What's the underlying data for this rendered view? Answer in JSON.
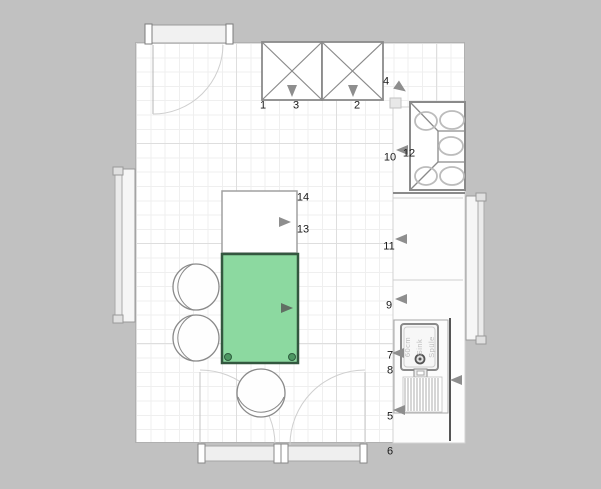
{
  "plan": {
    "colors": {
      "background": "#c1c1c1",
      "floor": "#ffffff",
      "grid_minor": "#efefef",
      "grid_major": "#dedede",
      "outline_gray": "#8a8a8a",
      "selection_fill": "#8cd9a0",
      "selection_border": "#33573f",
      "selection_handle": "#4d9762",
      "marker_gray": "#8e8e8e",
      "marker_dark": "#616f63"
    },
    "item_labels": [
      {
        "text": "1",
        "x": 263,
        "y": 106
      },
      {
        "text": "2",
        "x": 357,
        "y": 106
      },
      {
        "text": "3",
        "x": 296,
        "y": 106
      },
      {
        "text": "4",
        "x": 386,
        "y": 82
      },
      {
        "text": "5",
        "x": 390,
        "y": 417
      },
      {
        "text": "6",
        "x": 390,
        "y": 452
      },
      {
        "text": "7",
        "x": 390,
        "y": 356
      },
      {
        "text": "8",
        "x": 390,
        "y": 371
      },
      {
        "text": "9",
        "x": 389,
        "y": 306
      },
      {
        "text": "10",
        "x": 390,
        "y": 158
      },
      {
        "text": "11",
        "x": 389,
        "y": 247
      },
      {
        "text": "12",
        "x": 409,
        "y": 154
      },
      {
        "text": "13",
        "x": 303,
        "y": 230
      },
      {
        "text": "14",
        "x": 303,
        "y": 198
      }
    ],
    "sink_label_lines": [
      "60cm",
      "Sink",
      "Spüle"
    ],
    "orientation_markers": [
      {
        "x": 292,
        "y": 91,
        "rot": 90,
        "dark": false
      },
      {
        "x": 353,
        "y": 91,
        "rot": 90,
        "dark": false
      },
      {
        "x": 401,
        "y": 88,
        "rot": 35,
        "dark": false
      },
      {
        "x": 402,
        "y": 150,
        "rot": 180,
        "dark": false
      },
      {
        "x": 401,
        "y": 239,
        "rot": 180,
        "dark": false
      },
      {
        "x": 401,
        "y": 299,
        "rot": 180,
        "dark": false
      },
      {
        "x": 398,
        "y": 353,
        "rot": 180,
        "dark": false
      },
      {
        "x": 456,
        "y": 380,
        "rot": 180,
        "dark": false
      },
      {
        "x": 399,
        "y": 410,
        "rot": 180,
        "dark": false
      },
      {
        "x": 285,
        "y": 222,
        "rot": 0,
        "dark": false
      },
      {
        "x": 287,
        "y": 308,
        "rot": 0,
        "dark": true
      }
    ]
  }
}
